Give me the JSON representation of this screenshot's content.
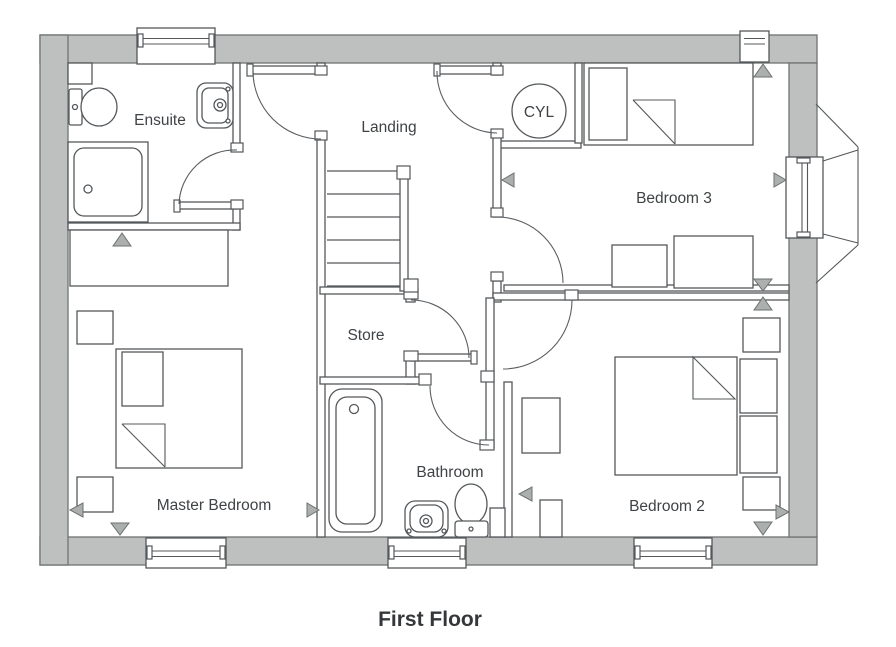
{
  "title": {
    "label": "First Floor"
  },
  "rooms": {
    "ensuite": "Ensuite",
    "landing": "Landing",
    "cyl": "CYL",
    "bedroom3": "Bedroom 3",
    "store": "Store",
    "master_bedroom": "Master Bedroom",
    "bathroom": "Bathroom",
    "bedroom2": "Bedroom 2"
  },
  "colors": {
    "exterior_wall_fill": "#bdc0bf",
    "line": "#54585b",
    "dimension_marker": "#abafae",
    "label_text": "#3f4346",
    "title_text": "#35383a",
    "background": "#ffffff"
  }
}
